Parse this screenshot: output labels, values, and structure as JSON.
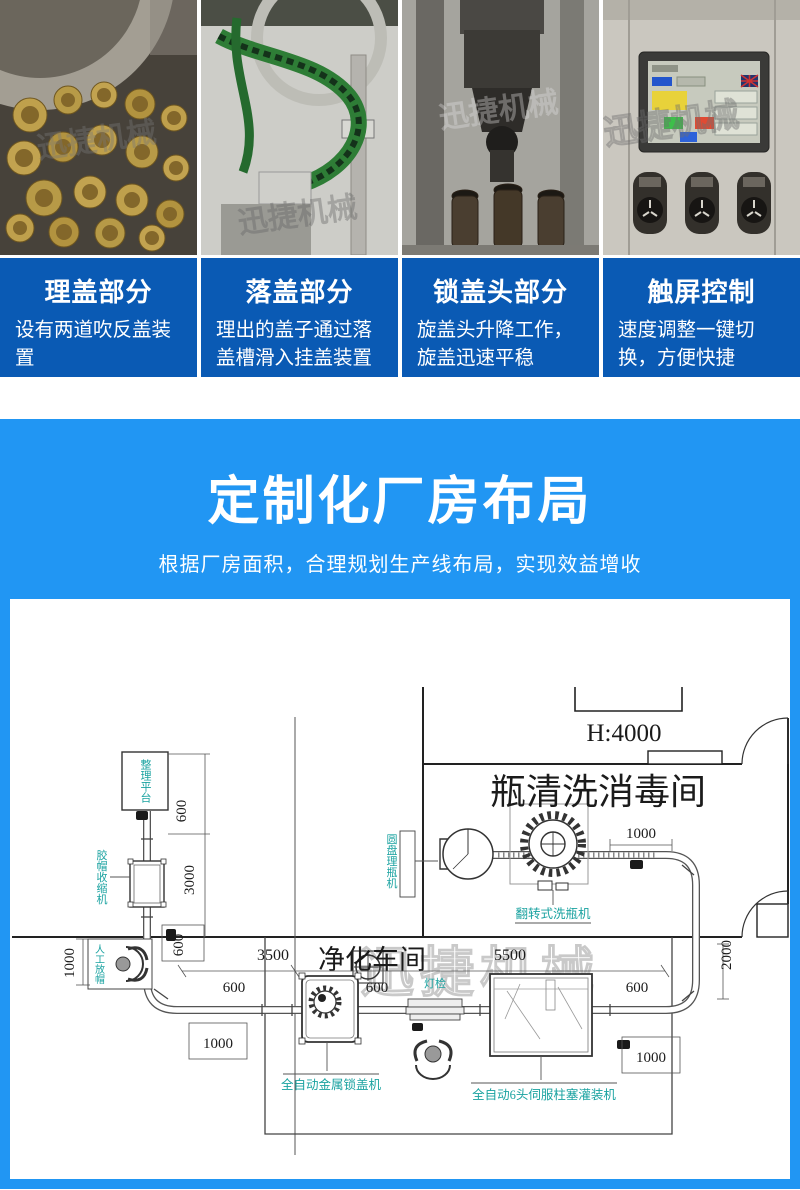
{
  "colors": {
    "card_blue": "#0a5ab4",
    "banner_blue": "#2196f3",
    "label_cyan": "#19a2a0"
  },
  "photos": {
    "watermark": "迅捷机械",
    "items": [
      {
        "name": "cap-sorting-bowl"
      },
      {
        "name": "cap-drop-chute"
      },
      {
        "name": "capping-heads"
      },
      {
        "name": "touchscreen-panel"
      }
    ]
  },
  "cards": [
    {
      "title": "理盖部分",
      "desc": "设有两道吹反盖装置"
    },
    {
      "title": "落盖部分",
      "desc": "理出的盖子通过落盖槽滑入挂盖装置"
    },
    {
      "title": "锁盖头部分",
      "desc": "旋盖头升降工作，旋盖迅速平稳"
    },
    {
      "title": "触屏控制",
      "desc": "速度调整一键切换，方便快捷"
    }
  ],
  "banner": {
    "title": "定制化厂房布局",
    "subtitle": "根据厂房面积，合理规划生产线布局，实现效益增收"
  },
  "floorplan": {
    "watermark": "迅捷机械",
    "rooms": {
      "wash_room": "瓶清洗消毒间",
      "clean_room": "净化车间",
      "ceiling_height": "H:4000"
    },
    "machines": {
      "sorting_platform": "整理平台",
      "cap_shrink": "胶帽收缩机",
      "manual_station": "人工放帽",
      "disc_unscrambler": "圆盘理瓶机",
      "rotary_washer": "翻转式洗瓶机",
      "capper": "全自动金属锁盖机",
      "filler": "全自动6头伺服柱塞灌装机",
      "light_inspect": "灯检"
    },
    "dims": {
      "d600": "600",
      "d1000": "1000",
      "d2000": "2000",
      "d3000": "3000",
      "d3500": "3500",
      "d5500": "5500"
    }
  }
}
